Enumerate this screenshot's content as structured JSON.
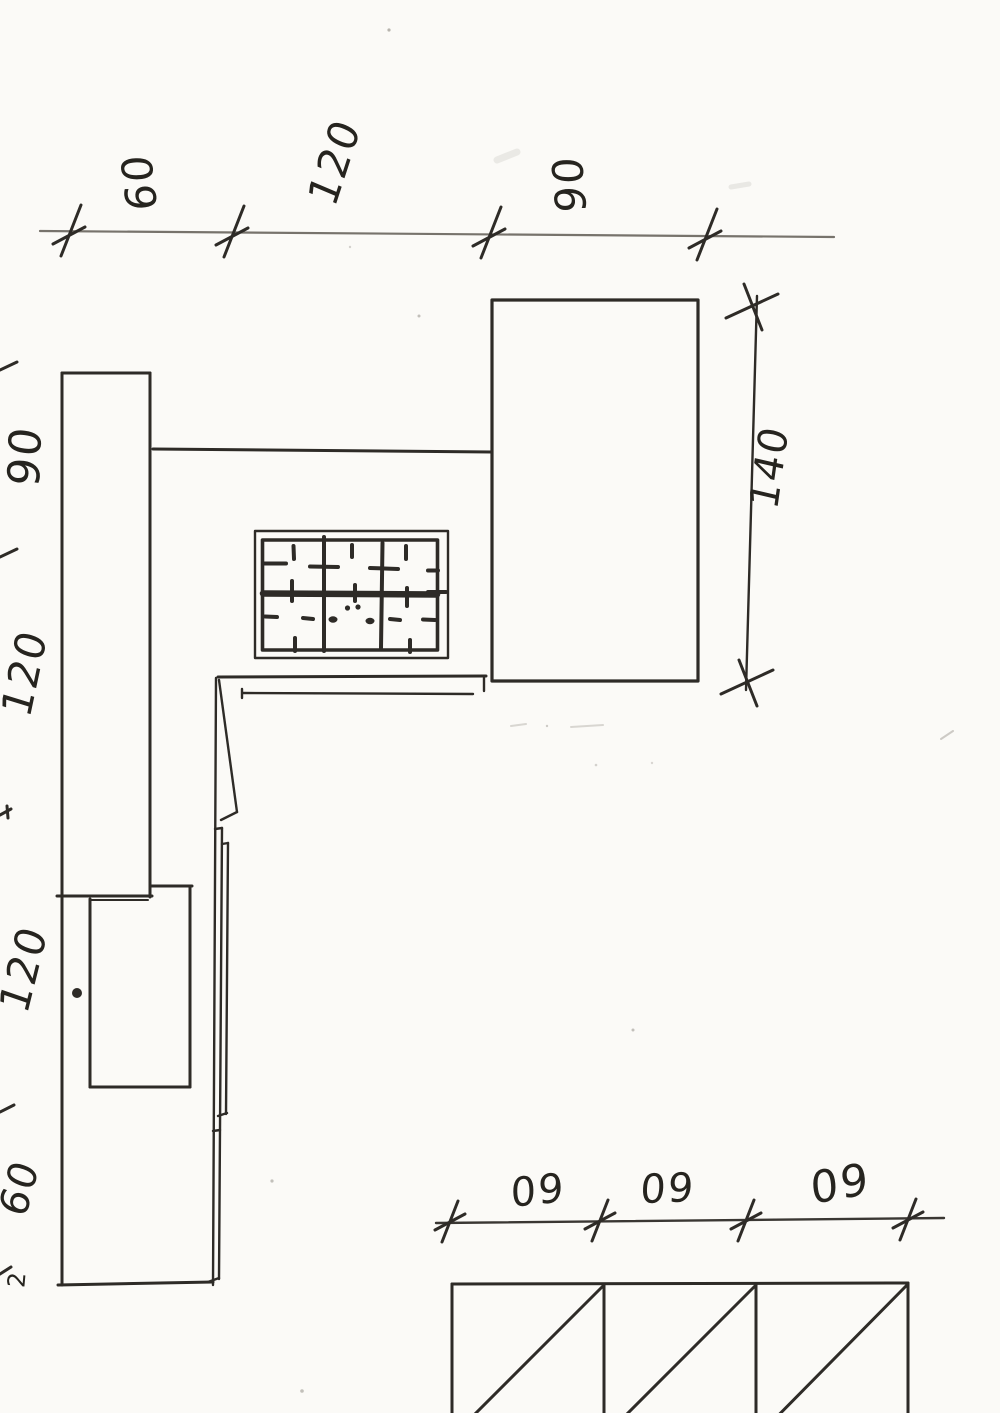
{
  "document": {
    "type": "hand-drawn kitchen plan sketch (scanned pencil drawing)"
  },
  "dimensions": {
    "top": {
      "labels": [
        "60",
        "120",
        "90"
      ]
    },
    "right": {
      "labels": [
        "140"
      ]
    },
    "left": {
      "labels": [
        "90",
        "120",
        "120",
        "60"
      ],
      "edge_mark": "2"
    },
    "bottom": {
      "labels": [
        "60",
        "60",
        "60"
      ]
    }
  },
  "colors": {
    "ink": "#2e2b27",
    "pencil": "#77736c",
    "paper": "#fbfaf7"
  }
}
